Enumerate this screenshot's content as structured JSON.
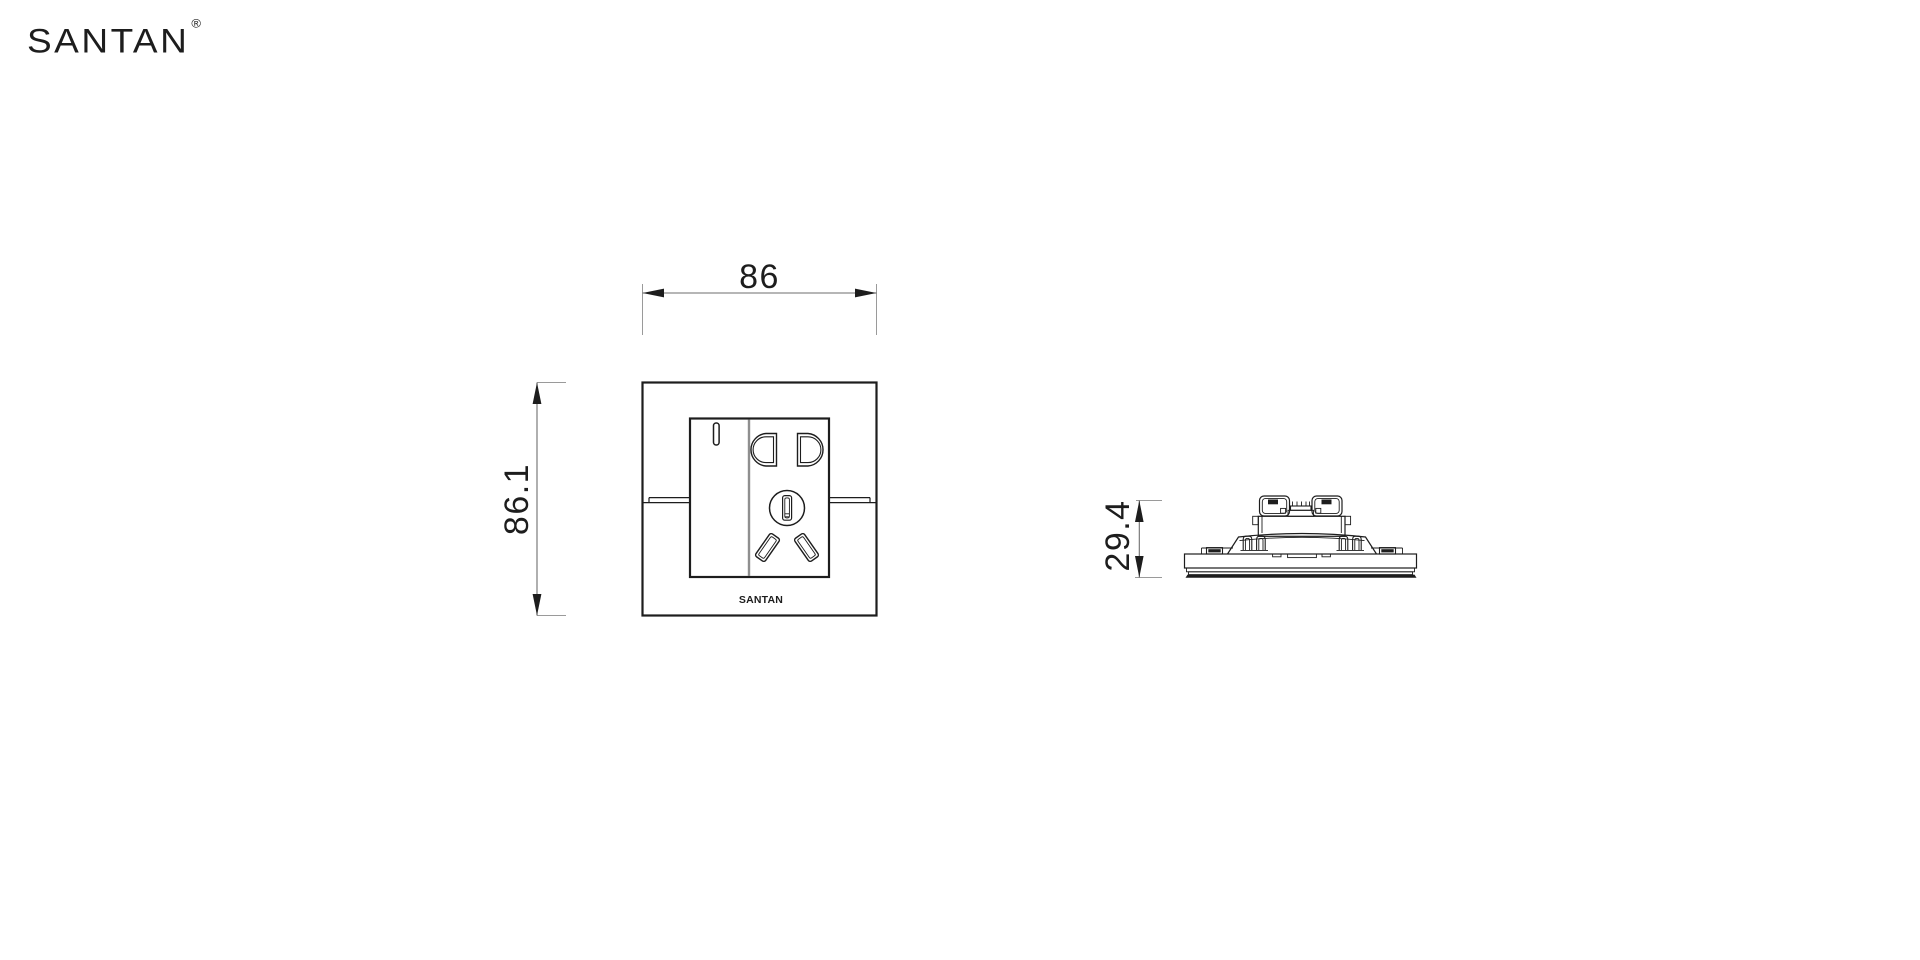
{
  "page": {
    "background": "#ffffff"
  },
  "brand": {
    "logo_text": "SANTAN",
    "registered_mark": "®"
  },
  "front_view": {
    "width_label": "86",
    "height_label": "86.1",
    "plate_logo": "SANTAN"
  },
  "side_view": {
    "depth_label": "29.4"
  },
  "colors": {
    "line": "#1d1d1d",
    "dim": "#6e6e6e",
    "ext": "#9a9a9a",
    "text": "#1d1d1d",
    "divider": "#8f8f8f",
    "background": "#ffffff"
  }
}
